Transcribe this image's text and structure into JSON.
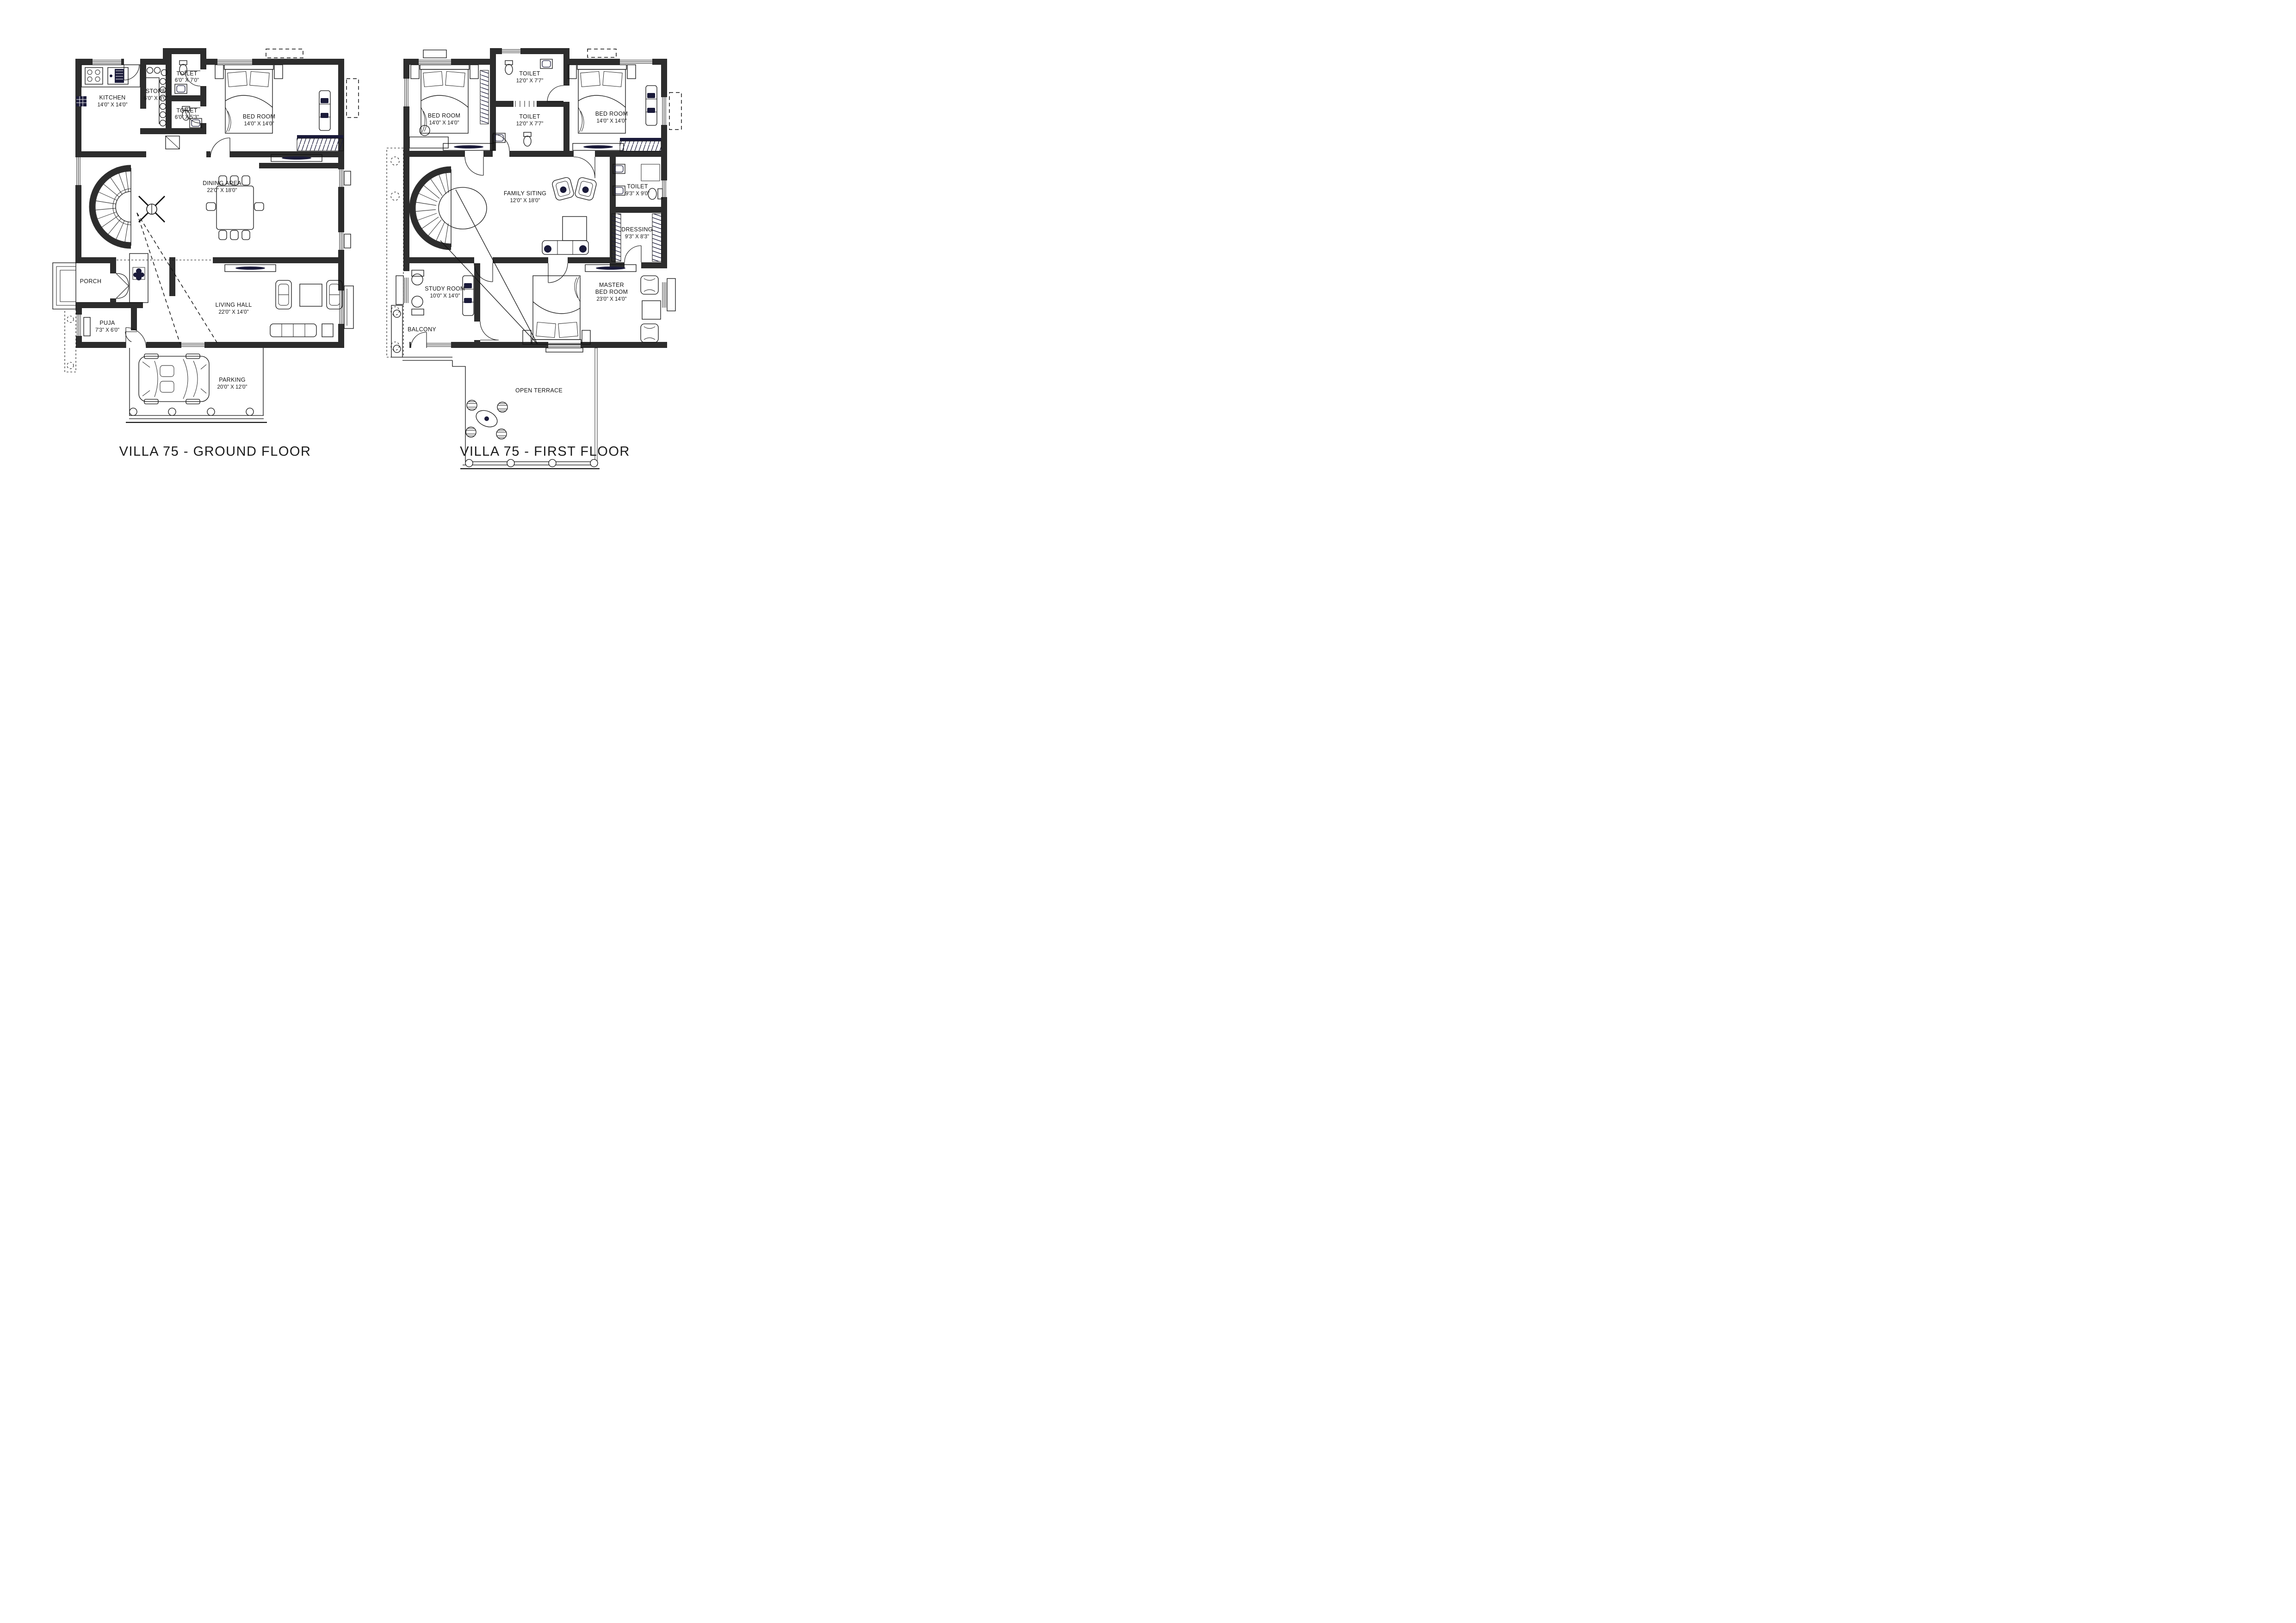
{
  "colors": {
    "wall": "#2d2d2d",
    "accent_navy": "#1b1b3a",
    "line": "#111111",
    "background": "#ffffff"
  },
  "titles": {
    "ground_floor": "VILLA 75 - GROUND FLOOR",
    "first_floor": "VILLA 75 - FIRST FLOOR"
  },
  "ground_floor": {
    "rooms": {
      "kitchen": {
        "name": "KITCHEN",
        "dims": "14'0\" X 14'0\""
      },
      "store": {
        "name": "STORE",
        "dims": "6'0\" X 8'0\""
      },
      "toilet_top": {
        "name": "TOILET",
        "dims": "6'0\" X 7'0\""
      },
      "toilet_bottom": {
        "name": "TOILET",
        "dims": "6'0\" X 5'3\""
      },
      "bed_room": {
        "name": "BED ROOM",
        "dims": "14'0\" X 14'0\""
      },
      "dining_area": {
        "name": "DINING AREA",
        "dims": "22'0\" X 18'0\""
      },
      "porch": {
        "name": "PORCH"
      },
      "puja": {
        "name": "PUJA",
        "dims": "7'3\" X 6'0\""
      },
      "living_hall": {
        "name": "LIVING HALL",
        "dims": "22'0\" X 14'0\""
      },
      "parking": {
        "name": "PARKING",
        "dims": "20'0\" X 12'0\""
      }
    }
  },
  "first_floor": {
    "rooms": {
      "bed_room_left": {
        "name": "BED ROOM",
        "dims": "14'0\" X 14'0\""
      },
      "toilet_top": {
        "name": "TOILET",
        "dims": "12'0\" X 7'7\""
      },
      "toilet_middle": {
        "name": "TOILET",
        "dims": "12'0\" X 7'7\""
      },
      "bed_room_right": {
        "name": "BED ROOM",
        "dims": "14'0\" X 14'0\""
      },
      "family_sitting": {
        "name": "FAMILY SITING",
        "dims": "12'0\" X 18'0\""
      },
      "toilet_right": {
        "name": "TOILET",
        "dims": "9'3\" X 9'0\""
      },
      "dressing": {
        "name": "DRESSING",
        "dims": "9'3\" X 8'3\""
      },
      "study_room": {
        "name": "STUDY ROOM",
        "dims": "10'0\" X 14'0\""
      },
      "balcony": {
        "name": "BALCONY"
      },
      "master_bed_room": {
        "line1": "MASTER",
        "line2": "BED ROOM",
        "dims": "23'0\" X 14'0\""
      },
      "open_terrace": {
        "name": "OPEN TERRACE"
      }
    }
  }
}
